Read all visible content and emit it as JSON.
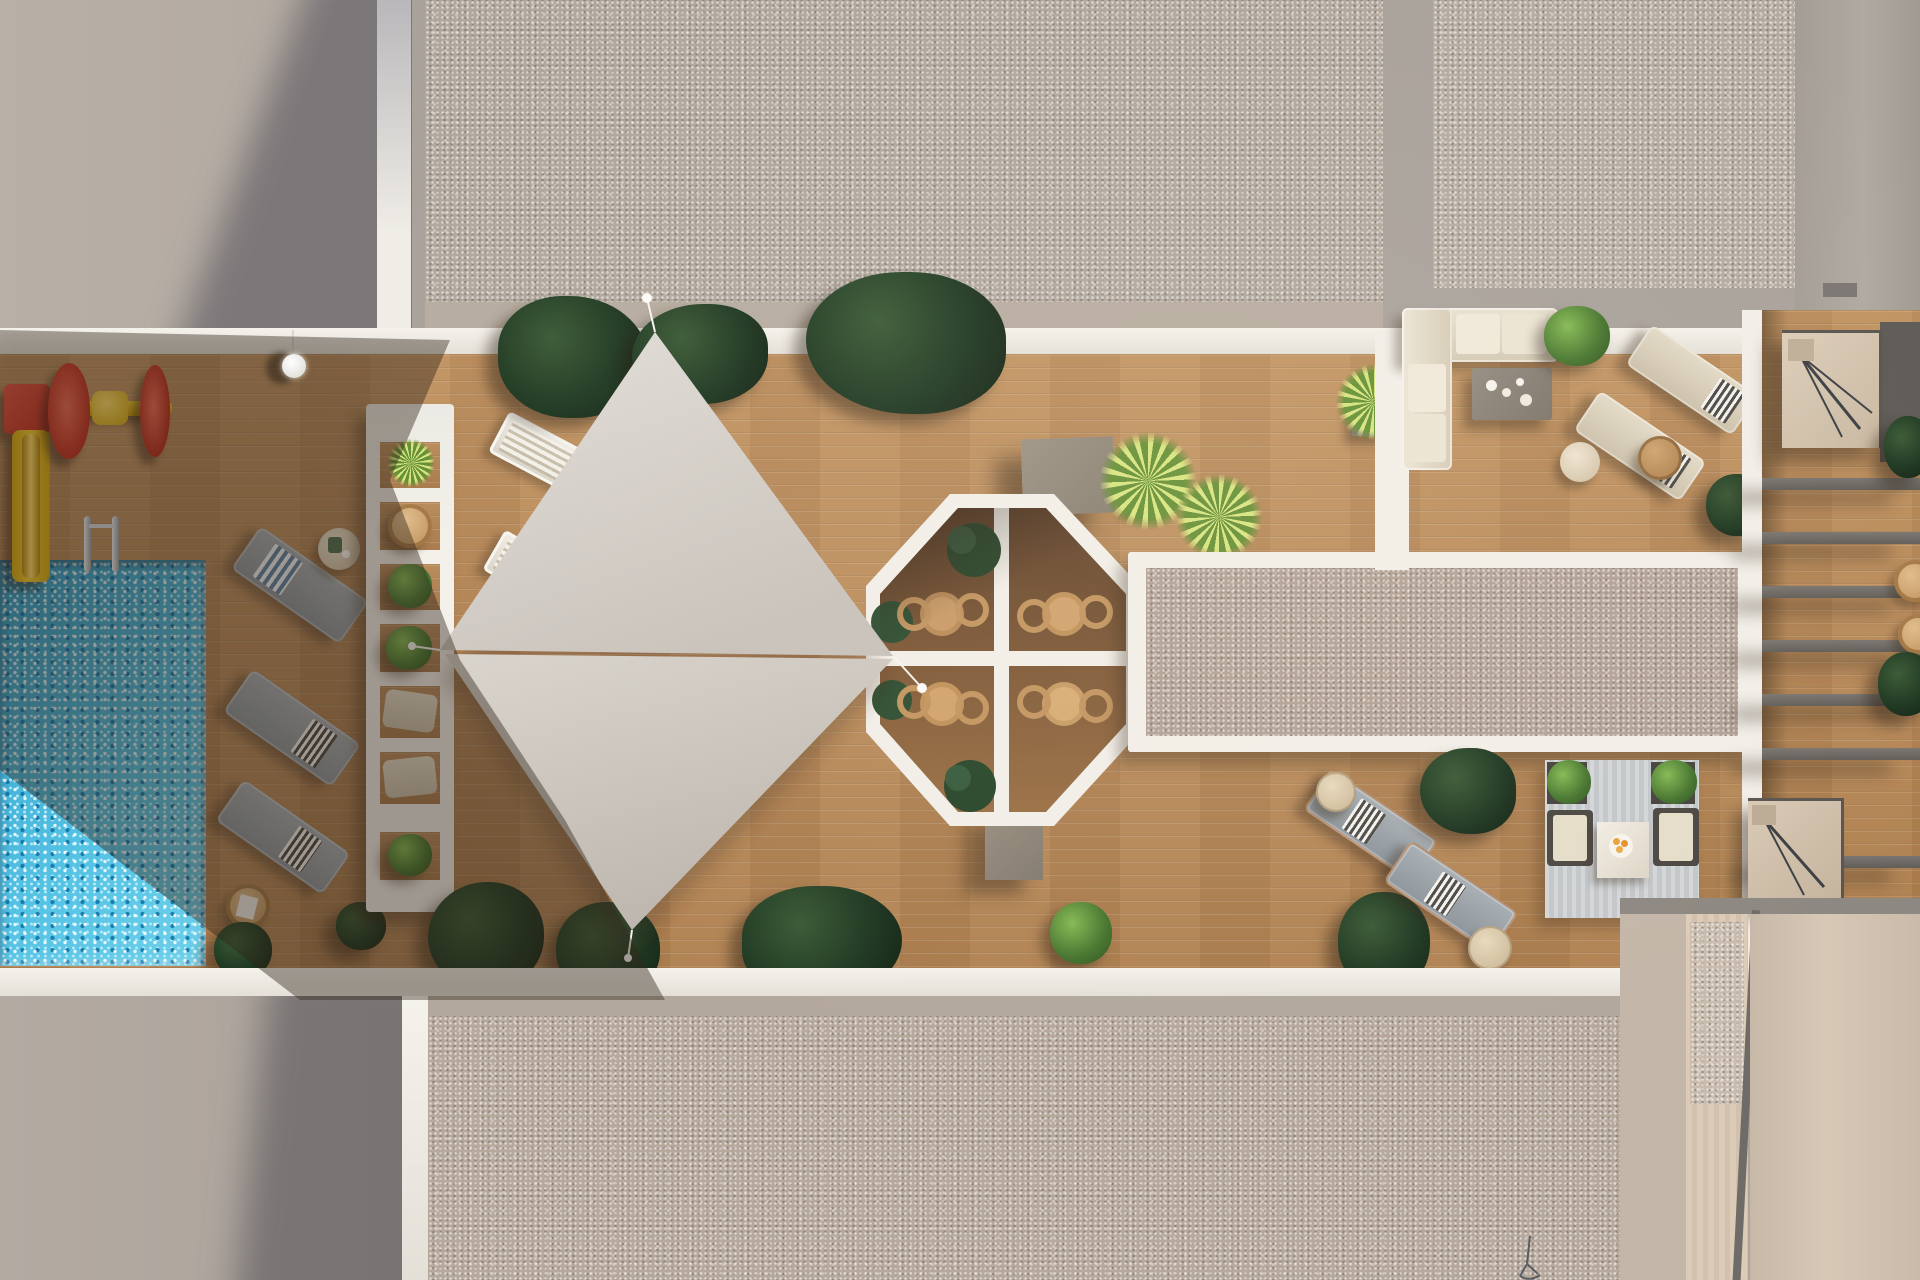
{
  "meta": {
    "domain": "Natural-Image",
    "title": "Rooftop terrace aerial rendering",
    "description": "Top-down 3D architectural rendering of a residential rooftop amenity deck: swimming pool with kids play corner, white slatted pergola, timber sun deck with two shade sails, octagonal dining pod with rattan chairs, gravel skylight strips, lounge sofas, sun loungers, striped-rug seating set and private stair terraces. Late sun casts a long diagonal shadow across the pool deck.",
    "render_style": "photorealistic top view, no visible text"
  },
  "palette": {
    "roof_concrete": "#b4aba2",
    "roof_gravel": "#b1a79d",
    "deck_wood": "#b88c5f",
    "deck_wood_shadow": "#6e4c31",
    "pool_water": "#41b2d9",
    "structure_white": "#f2efe9",
    "sail_fabric": "#d8d3cc",
    "plant_dark_green": "#203a23",
    "plant_bright_green": "#47762f",
    "yucca_green": "#a7c85a",
    "rattan_tan": "#c2945e",
    "cushion_beige": "#e3dac7",
    "lounger_gray": "#9aa2a8",
    "playground_red": "#d8392b",
    "playground_yellow": "#f2c51d",
    "taupe_box": "#93897c",
    "slat_gray": "#6e6a66",
    "stair_beige": "#d5c5b1",
    "rug_gray": "#ced2d4",
    "citrus_orange": "#e8a23c"
  },
  "zones": [
    {
      "id": "roof-top-left",
      "label": "Upper concrete roof slab (partly in shadow)"
    },
    {
      "id": "gravel-roof-top",
      "label": "Top gravel roof section"
    },
    {
      "id": "gravel-roof-top-right",
      "label": "Top-right gravel roof section"
    },
    {
      "id": "roof-top-right",
      "label": "Top-right concrete roof corner"
    },
    {
      "id": "pool-deck",
      "label": "Shaded pool deck with playground corner"
    },
    {
      "id": "pool",
      "label": "Mosaic swimming pool with ladder"
    },
    {
      "id": "pergola",
      "label": "White slatted pergola with planted openings"
    },
    {
      "id": "sun-deck",
      "label": "Main timber sun deck"
    },
    {
      "id": "shade-sails",
      "label": "Two triangular shade sails on poles"
    },
    {
      "id": "dining-octagon",
      "label": "Octagonal dining pod, four tables with rattan chairs"
    },
    {
      "id": "skylight-gravel",
      "label": "Gravel-filled skylight strip with white frame"
    },
    {
      "id": "sofa-corner",
      "label": "L-shaped sofa lounge with coffee table"
    },
    {
      "id": "lounger-corner",
      "label": "Paired sun loungers with side tables"
    },
    {
      "id": "rug-lounge",
      "label": "Outdoor seating set on striped rug"
    },
    {
      "id": "stair-terraces",
      "label": "Private terraces with stairwells and louver slats"
    },
    {
      "id": "gravel-roof-bottom",
      "label": "Bottom gravel roof section"
    },
    {
      "id": "roof-bottom-left",
      "label": "Lower concrete roof slab"
    },
    {
      "id": "courtyard-bottom-right",
      "label": "Bottom-right courtyard roof bands"
    }
  ],
  "furniture": {
    "gray_loungers": 3,
    "white_loungers": 2,
    "beige_loungers": 4,
    "dining_tables": 4,
    "rattan_chairs": 8,
    "side_tables": 7,
    "l_shaped_sofa": 1,
    "coffee_tables": 2,
    "armchairs": 2,
    "poufs": 2,
    "rug": 1,
    "stairwells": 2,
    "pendant_light": 1,
    "pool_ladder": 1,
    "playground": {
      "slide": 1,
      "spinner_wheel": 1
    },
    "taupe_planter_boxes": 2,
    "drain_sketch": 1
  },
  "plants": {
    "dark_tropical_clusters": 9,
    "bright_shrubs": 6,
    "yucca_palms": 3,
    "octagon_shrubs": 4,
    "pergola_planters": 4
  }
}
